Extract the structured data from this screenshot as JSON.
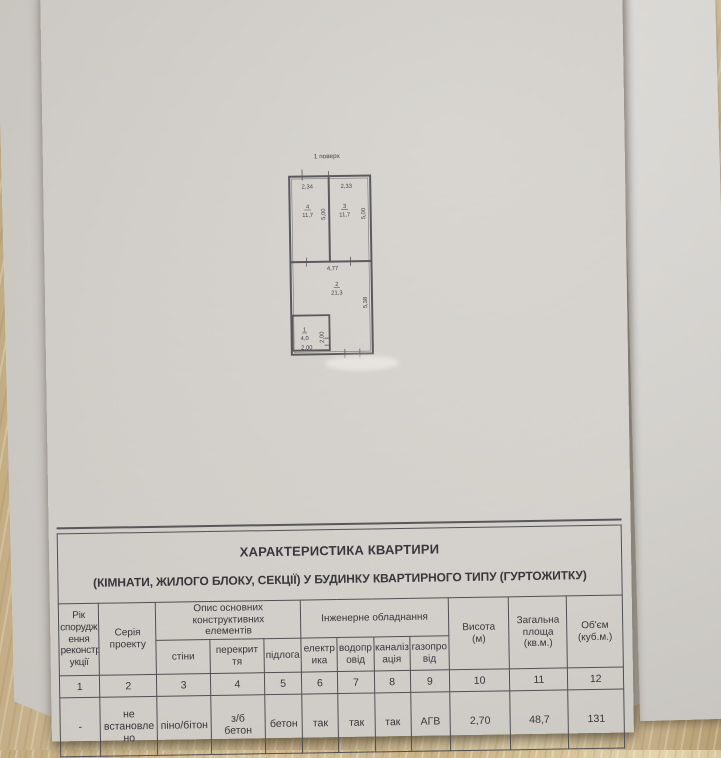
{
  "plan": {
    "title": "1 поверх",
    "room4": {
      "num": "4",
      "area": "11,7"
    },
    "room3": {
      "num": "3",
      "area": "11,7"
    },
    "room2": {
      "num": "2",
      "area": "21,3"
    },
    "room1": {
      "num": "1",
      "area": "4,0"
    },
    "dims": {
      "w4": "2,34",
      "w3": "2,33",
      "h4": "5,00",
      "h3": "5,00",
      "w2": "4,77",
      "h2": "5,38",
      "w1": "2,00",
      "h1": "2,00"
    }
  },
  "table": {
    "title_line1": "ХАРАКТЕРИСТИКА КВАРТИРИ",
    "title_line2": "(КІМНАТИ, ЖИЛОГО БЛОКУ, СЕКЦІЇ) У БУДИНКУ КВАРТИРНОГО ТИПУ (ГУРТОЖИТКУ)",
    "headers": {
      "col1": "Рік\nспорудж\nення\nреконстр\nукції",
      "col2": "Серія\nпроекту",
      "group_construction": "Опис основних конструктивних\nелементів",
      "sub_walls": "стіни",
      "sub_ceiling": "перекрит\nтя",
      "sub_floor": "підлога",
      "group_engineering": "Інженерне обладнання",
      "sub_electricity": "електр\nика",
      "sub_water": "водопр\nовід",
      "sub_sewer": "каналіз\nація",
      "sub_gas": "газопро\nвід",
      "col10": "Висота\n(м)",
      "col11": "Загальна\nплоща\n(кв.м.)",
      "col12": "Об'єм\n(куб.м.)"
    },
    "column_numbers": [
      "1",
      "2",
      "3",
      "4",
      "5",
      "6",
      "7",
      "8",
      "9",
      "10",
      "11",
      "12"
    ],
    "data_row": [
      "-",
      "не\nвстановле\nно",
      "піно/бітон",
      "з/б\nбетон",
      "бетон",
      "так",
      "так",
      "так",
      "АГВ",
      "2,70",
      "48,7",
      "131"
    ]
  }
}
